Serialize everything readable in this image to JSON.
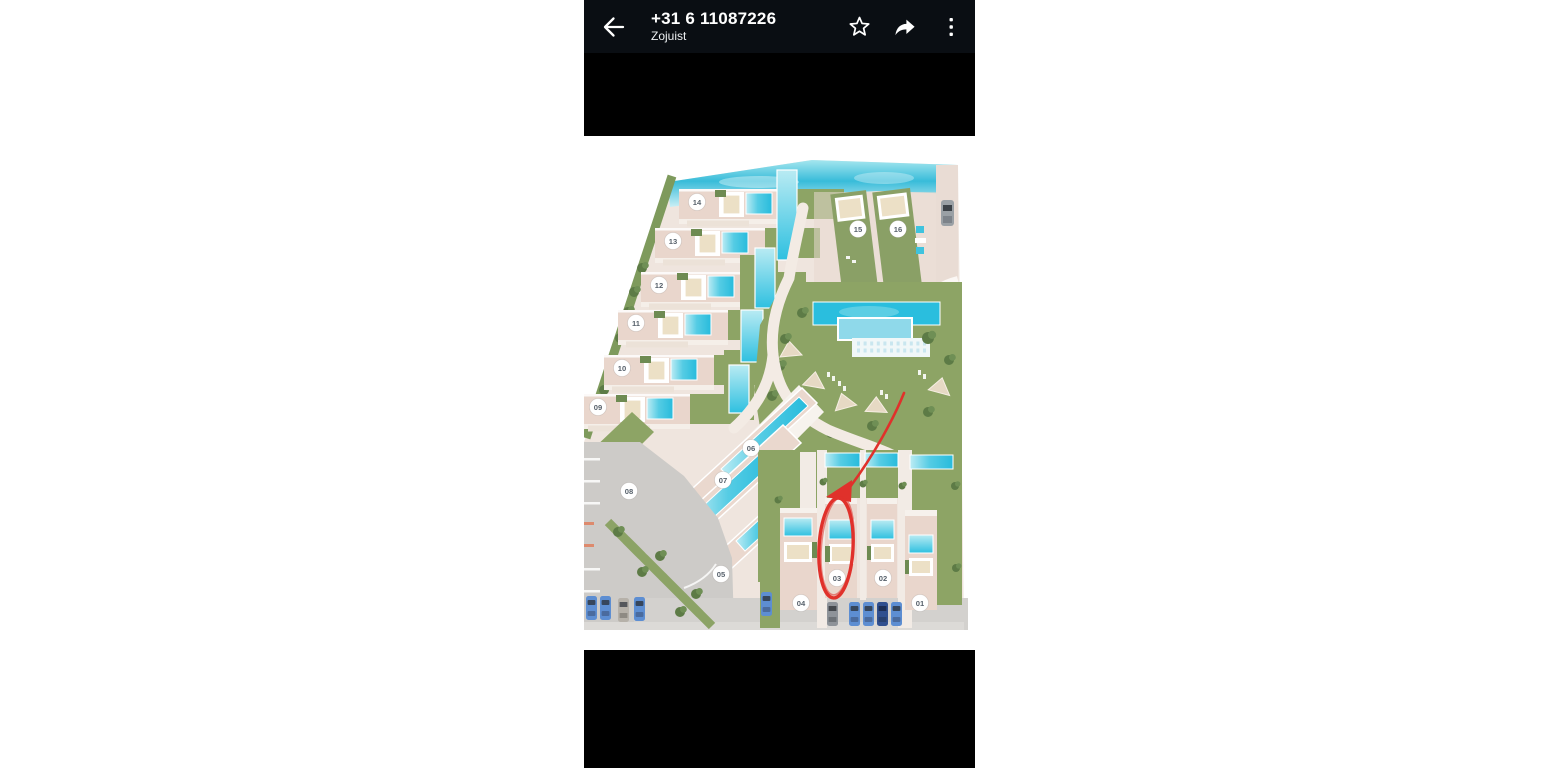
{
  "header": {
    "title": "+31 6 11087226",
    "subtitle": "Zojuist",
    "back_icon": "back-arrow",
    "actions": [
      {
        "name": "favorite",
        "icon": "star-outline"
      },
      {
        "name": "forward",
        "icon": "share-forward-arrow"
      },
      {
        "name": "menu",
        "icon": "more-vertical-dots"
      }
    ]
  },
  "photo": {
    "kind": "resort-site-plan-image",
    "villas": [
      {
        "n": "01",
        "x": 336,
        "y": 453
      },
      {
        "n": "02",
        "x": 299,
        "y": 428
      },
      {
        "n": "03",
        "x": 253,
        "y": 428
      },
      {
        "n": "04",
        "x": 217,
        "y": 453
      },
      {
        "n": "05",
        "x": 137,
        "y": 424
      },
      {
        "n": "06",
        "x": 167,
        "y": 298
      },
      {
        "n": "07",
        "x": 139,
        "y": 330
      },
      {
        "n": "08",
        "x": 45,
        "y": 341
      },
      {
        "n": "09",
        "x": 14,
        "y": 257
      },
      {
        "n": "10",
        "x": 38,
        "y": 218
      },
      {
        "n": "11",
        "x": 52,
        "y": 173
      },
      {
        "n": "12",
        "x": 75,
        "y": 135
      },
      {
        "n": "13",
        "x": 89,
        "y": 91
      },
      {
        "n": "14",
        "x": 113,
        "y": 52
      },
      {
        "n": "15",
        "x": 274,
        "y": 79
      },
      {
        "n": "16",
        "x": 314,
        "y": 79
      }
    ],
    "annotation": {
      "shape": "arrow-and-ellipse",
      "highlighted_villa": "03",
      "color": "#e0312b"
    },
    "colors": {
      "sea": "#38bcd9",
      "pool": "#2ec0e0",
      "lawn": "#8da465",
      "tree": "#5d7b46",
      "land": "#efe5de",
      "building": "#e9d6cc",
      "road": "#cdcbc8",
      "badge_fill": "#ffffff",
      "badge_text": "#57616b"
    }
  }
}
